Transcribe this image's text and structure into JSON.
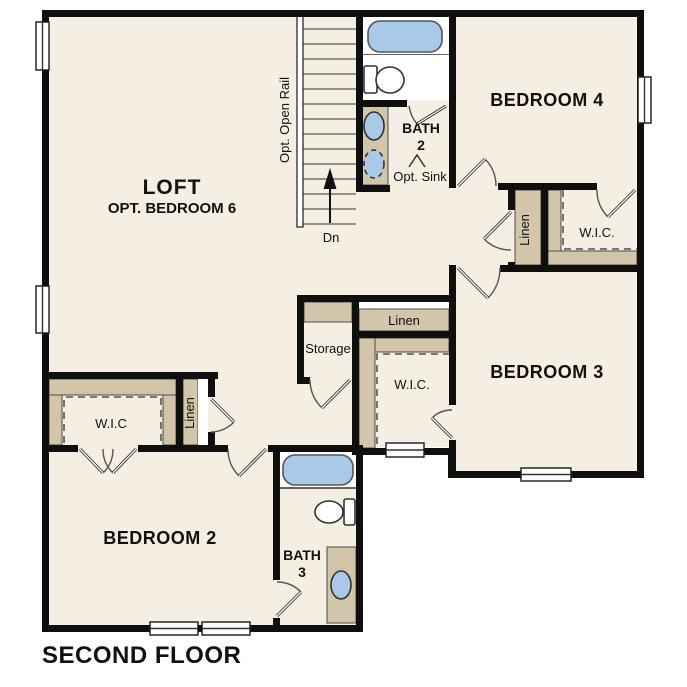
{
  "title": "SECOND FLOOR",
  "colors": {
    "background": "#ffffff",
    "floor": "#f5eee2",
    "wall": "#0f0f0f",
    "closet_shelf_tan": "#d2c5aa",
    "fixture_blue": "#a9c9e9",
    "fixture_white": "#ffffff"
  },
  "rooms": {
    "loft": {
      "label": "LOFT",
      "sublabel": "OPT. BEDROOM 6"
    },
    "bedroom2": {
      "label": "BEDROOM 2"
    },
    "bedroom3": {
      "label": "BEDROOM 3"
    },
    "bedroom4": {
      "label": "BEDROOM 4"
    },
    "bath2": {
      "name_line1": "BATH",
      "name_line2": "2",
      "option_label": "Opt. Sink"
    },
    "bath3": {
      "name_line1": "BATH",
      "name_line2": "3"
    },
    "storage": {
      "label": "Storage"
    },
    "closets": {
      "linen_upper_hall": "Linen",
      "linen_lower_hall": "Linen",
      "linen_bedroom2": "Linen",
      "wic_bedroom4": "W.I.C.",
      "wic_bedroom3": "W.I.C.",
      "wic_bedroom2": "W.I.C"
    }
  },
  "stairs": {
    "direction_label": "Dn",
    "rail_label": "Opt. Open Rail"
  }
}
